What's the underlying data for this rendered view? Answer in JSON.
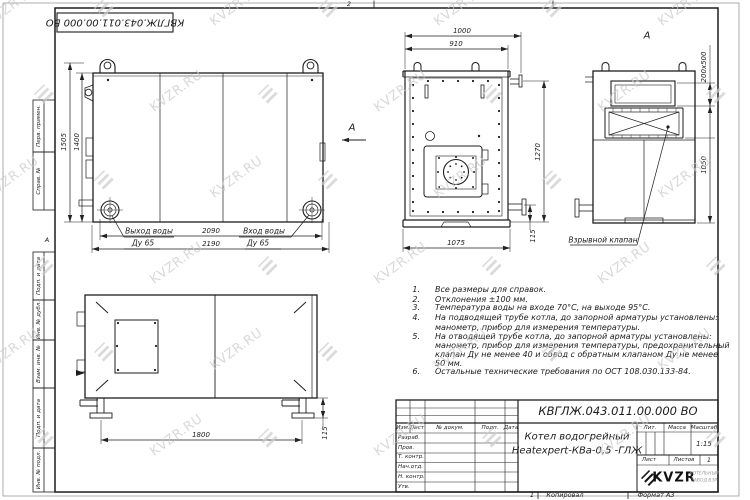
{
  "sheet": {
    "top_stamp": "КВГЛЖ.043.011.00.000 ВО",
    "zone_top": "2",
    "zone_bottom": "1",
    "zone_left_marker": "А",
    "copied_label": "Копировал",
    "format_label": "Формат А3",
    "margin_fields": [
      "Перв. примен.",
      "Справ. №",
      "Подп. и дата",
      "Инв. № дубл.",
      "Взам. инв. №",
      "Подп. и дата",
      "Инв. № подл."
    ]
  },
  "watermark": {
    "text": "KVZR.RU",
    "color": "#c9c9c9"
  },
  "views": {
    "front": {
      "dims": {
        "height_outer": "1505",
        "height_body": "1400",
        "width_inner": "2090",
        "width_outer": "2190"
      },
      "labels": {
        "outlet": "Выход воды",
        "outlet_dn": "Ду 65",
        "inlet": "Вход воды",
        "inlet_dn": "Ду 65"
      },
      "view_arrow": "А"
    },
    "back": {
      "dims": {
        "top_outer": "1000",
        "top_inner": "910",
        "height": "1270",
        "stub": "115",
        "bottom": "1075"
      }
    },
    "view_a": {
      "label": "А",
      "dims": {
        "valve": "200х500",
        "height": "1050"
      },
      "callout": "Взрывной клапан"
    },
    "side": {
      "dims": {
        "length": "1800",
        "leg": "115"
      }
    }
  },
  "notes": {
    "items": [
      {
        "num": "1.",
        "lines": [
          "Все размеры для справок."
        ]
      },
      {
        "num": "2.",
        "lines": [
          "Отклонения ±100 мм."
        ]
      },
      {
        "num": "3.",
        "lines": [
          "Температура воды на входе 70°С, на выходе 95°С."
        ]
      },
      {
        "num": "4.",
        "lines": [
          "На подводящей трубе котла, до запорной арматуры установлены:",
          "манометр, прибор для измерения температуры."
        ]
      },
      {
        "num": "5.",
        "lines": [
          "На отводящей трубе котла, до запорной арматуры установлены:",
          "манометр, прибор для измерения температуры, предохранительный",
          "клапан Ду не менее 40 и обвод с обратным клапаном Ду не менее",
          "50 мм."
        ]
      },
      {
        "num": "6.",
        "lines": [
          "Остальные технические требования по ОСТ 108.030.133-84."
        ]
      }
    ]
  },
  "title_block": {
    "designation": "КВГЛЖ.043.011.00.000 ВО",
    "name_line1": "Котел водогрейный",
    "name_line2": "Heatexpert-КВа-0,5 -ГЛЖ",
    "headers": {
      "izm": "Изм.",
      "list": "Лист",
      "doc": "№ докум.",
      "podp": "Подп.",
      "data": "Дата",
      "lit": "Лит.",
      "massa": "Масса",
      "scale": "Масштаб",
      "sheet": "Лист",
      "sheets": "Листов"
    },
    "rows": [
      "Разраб.",
      "Пров.",
      "Т. контр.",
      "Нач.отд.",
      "Н. контр.",
      "Утв."
    ],
    "scale_value": "1:15",
    "sheets_value": "1",
    "logo": {
      "text": "KVZR",
      "sub1": "КОТЕЛЬНЫЙ",
      "sub2": "ЗАВОД ВЗР"
    }
  }
}
